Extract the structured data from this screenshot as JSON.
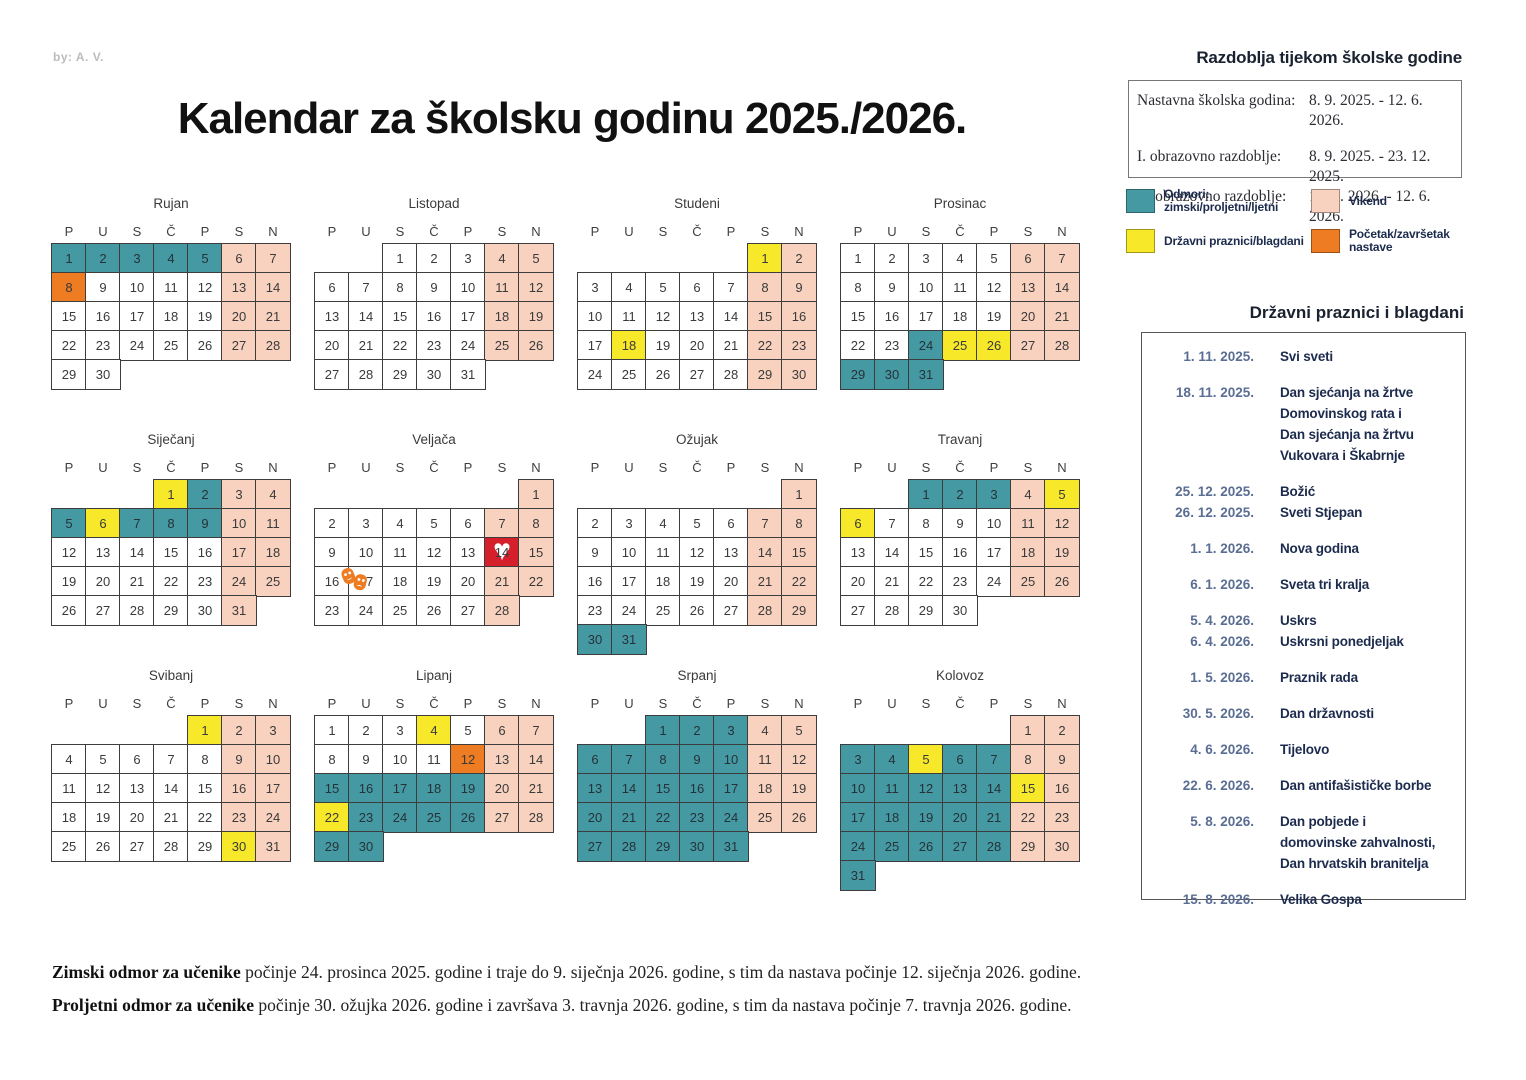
{
  "credit": "by: A. V.",
  "title": "Kalendar za školsku godinu 2025./2026.",
  "periods": {
    "title": "Razdoblja tijekom školske godine",
    "rows": [
      {
        "label": "Nastavna školska godina:",
        "value": "8. 9. 2025. - 12. 6. 2026."
      },
      {
        "label": "I. obrazovno razdoblje:",
        "value": "8. 9. 2025. - 23. 12. 2025."
      },
      {
        "label": "II. obrazovno razdoblje:",
        "value": "12. 1. 2026. - 12. 6. 2026."
      }
    ]
  },
  "legend": [
    {
      "key": "break",
      "color": "#4599a3",
      "label": "Odmori:\nzimski/proljetni/ljetni"
    },
    {
      "key": "weekend",
      "color": "#f8d2bf",
      "label": "Vikend"
    },
    {
      "key": "holiday",
      "color": "#f7e829",
      "label": "Državni praznici/blagdani"
    },
    {
      "key": "startend",
      "color": "#ed7c23",
      "label": "Početak/završetak nastave"
    }
  ],
  "holidays": {
    "title": "Državni praznici i blagdani",
    "items": [
      {
        "date": "1. 11. 2025.",
        "name": "Svi sveti",
        "tight": false
      },
      {
        "date": "18. 11. 2025.",
        "name": "Dan sjećanja na žrtve\nDomovinskog rata i\nDan sjećanja na žrtvu\nVukovara i Škabrnje",
        "tight": false
      },
      {
        "date": "25. 12. 2025.",
        "name": "Božić",
        "tight": false
      },
      {
        "date": "26. 12. 2025.",
        "name": "Sveti Stjepan",
        "tight": true
      },
      {
        "date": "1. 1. 2026.",
        "name": "Nova godina",
        "tight": false
      },
      {
        "date": "6. 1. 2026.",
        "name": "Sveta tri kralja",
        "tight": false
      },
      {
        "date": "5. 4. 2026.",
        "name": "Uskrs",
        "tight": false
      },
      {
        "date": "6. 4. 2026.",
        "name": "Uskrsni ponedjeljak",
        "tight": true
      },
      {
        "date": "1. 5. 2026.",
        "name": "Praznik rada",
        "tight": false
      },
      {
        "date": "30. 5. 2026.",
        "name": "Dan državnosti",
        "tight": false
      },
      {
        "date": "4. 6. 2026.",
        "name": "Tijelovo",
        "tight": false
      },
      {
        "date": "22. 6. 2026.",
        "name": "Dan antifašističke borbe",
        "tight": false
      },
      {
        "date": "5. 8. 2026.",
        "name": "Dan pobjede i\ndomovinske zahvalnosti,\nDan hrvatskih branitelja",
        "tight": false
      },
      {
        "date": "15. 8. 2026.",
        "name": "Velika Gospa",
        "tight": false
      }
    ]
  },
  "calendar": {
    "day_headers": [
      "P",
      "U",
      "S",
      "Č",
      "P",
      "S",
      "N"
    ],
    "cell_types": {
      "w": "workday",
      "e": "weekend",
      "h": "holiday",
      "b": "break",
      "s": "startend",
      "R": "valentine-heart",
      "M": "carnival-masks"
    },
    "months": [
      {
        "name": "Rujan",
        "start": 0,
        "pattern": "bbbbbeeswwwweewwwwweewwwwweeww"
      },
      {
        "name": "Listopad",
        "start": 2,
        "pattern": "wwweewwwwweewwwwweewwwwweewwwww"
      },
      {
        "name": "Studeni",
        "start": 5,
        "pattern": "hewwwwweewwwwweewhwwweewwwwwee"
      },
      {
        "name": "Prosinac",
        "start": 0,
        "pattern": "wwwwweewwwwweewwwwweewwbhheebbb"
      },
      {
        "name": "Siječanj",
        "start": 3,
        "pattern": "hbeebhbbbeewwwwweewwwwweewwwwwe"
      },
      {
        "name": "Veljača",
        "start": 6,
        "pattern": "ewwwwweewwwwwRewMwwweewwwwwe"
      },
      {
        "name": "Ožujak",
        "start": 6,
        "pattern": "ewwwwweewwwwweewwwwweewwwwweebb"
      },
      {
        "name": "Travanj",
        "start": 2,
        "pattern": "bbbehhwwwweewwwwweewwwwweewwww"
      },
      {
        "name": "Svibanj",
        "start": 4,
        "pattern": "heewwwwweewwwwweewwwwweewwwwwhe"
      },
      {
        "name": "Lipanj",
        "start": 0,
        "pattern": "wwwhweewwwwseebbbbbeehbbbbeebb"
      },
      {
        "name": "Srpanj",
        "start": 2,
        "pattern": "bbbeebbbbbeebbbbbeebbbbbeebbbbb"
      },
      {
        "name": "Kolovoz",
        "start": 5,
        "pattern": "eebbhbbeebbbbbhebbbbbeebbbbbeeb"
      }
    ]
  },
  "icons": {
    "heart": "♥",
    "masks": "theater-masks",
    "heart_bg": "#d5202c",
    "masks_color": "#ed7c23"
  },
  "footnotes": [
    {
      "bold": "Zimski odmor za učenike",
      "text": " počinje 24. prosinca 2025. godine i traje do 9. siječnja 2026. godine, s tim da nastava počinje 12. siječnja 2026. godine."
    },
    {
      "bold": "Proljetni odmor za učenike",
      "text": " počinje 30. ožujka 2026. godine i završava 3. travnja 2026. godine, s tim da nastava počinje 7. travnja 2026. godine."
    }
  ]
}
